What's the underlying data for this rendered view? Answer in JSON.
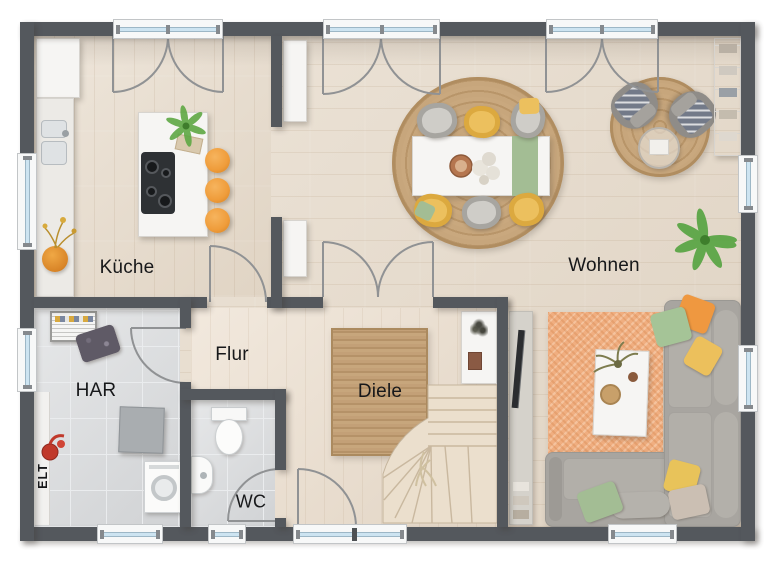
{
  "rooms": {
    "kueche": "Küche",
    "wohnen": "Wohnen",
    "flur": "Flur",
    "diele": "Diele",
    "har": "HAR",
    "wc": "WC",
    "elt": "ELT"
  },
  "colors": {
    "wall": "#54585d",
    "floor_wood": "#e7dbcb",
    "floor_tile": "#d9dbdd",
    "rug_jute": "#c7a67c",
    "rug_orange": "#f0ae80",
    "accent_orange": "#ef9c3a",
    "chair_yellow": "#ecc05e",
    "green": "#a3bd94",
    "sofa_gray": "#a8a5a0",
    "armchair_gray": "#8f8c88",
    "glass": "#cde4f1",
    "stairs_wood": "#ebdfcd",
    "white_furniture": "#f6f5f3",
    "cooktop": "#2e3134",
    "arc_gray": "#909294",
    "text": "#17181a"
  }
}
